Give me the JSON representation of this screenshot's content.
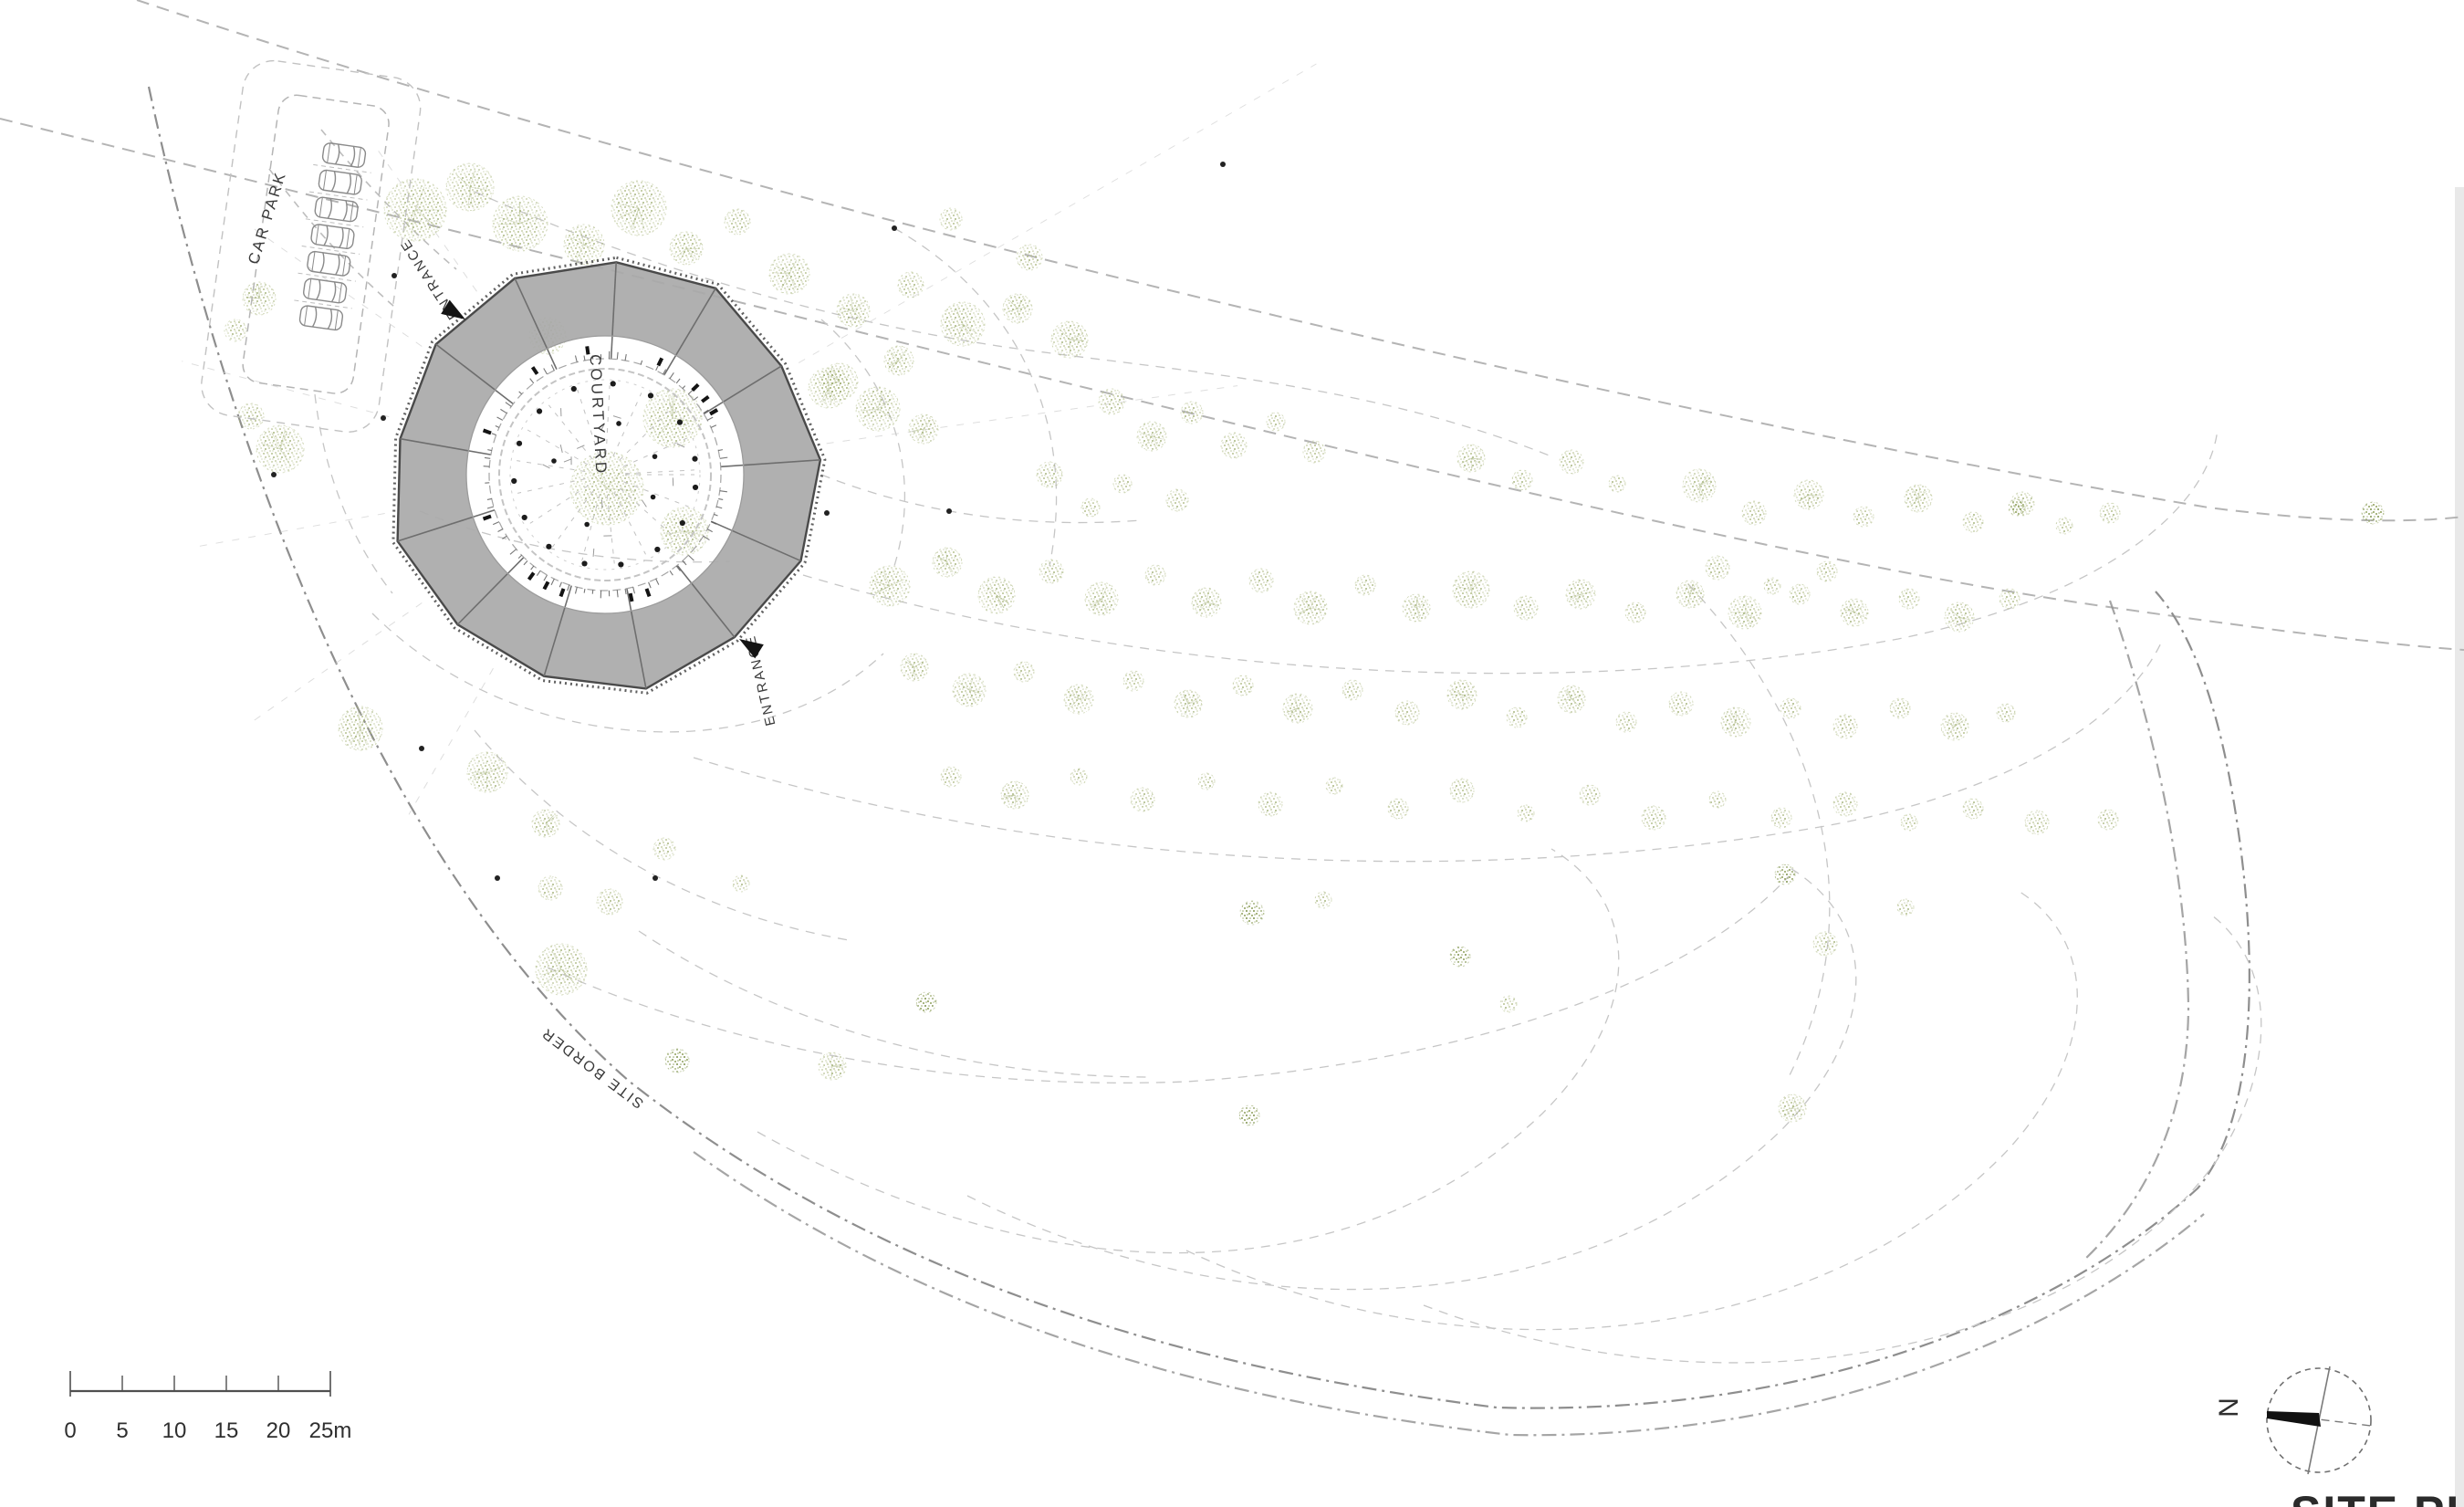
{
  "page": {
    "title_block": "SITE PLAN",
    "north_label": "N"
  },
  "labels": {
    "car_park": "CAR PARK",
    "entrance_upper": "ENTRANCE",
    "entrance_lower": "ENTRANCE",
    "courtyard": "COURTYARD",
    "site_border": "SITE BORDER"
  },
  "scale_bar": {
    "ticks": [
      "0",
      "5",
      "10",
      "15",
      "20",
      "25m"
    ]
  },
  "colors": {
    "tree_fill": "#a9b57b",
    "tree_dark": "#8fa05a",
    "building_gray": "#a9a9a9",
    "boundary_line": "#8e8e8e",
    "ink": "#333333",
    "paper": "#ffffff"
  }
}
